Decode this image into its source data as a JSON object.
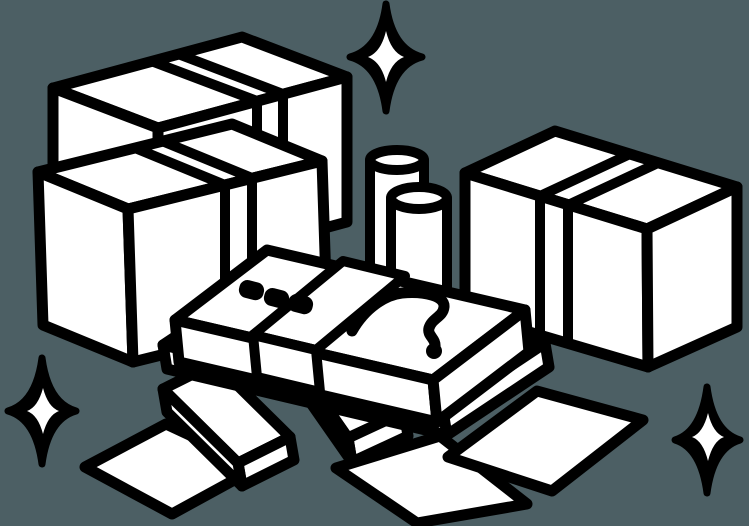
{
  "scene": {
    "title": "Packed boxes and money pile clipart",
    "description": "Monochrome line-art illustration of sealed cardboard boxes, coin rolls, a banded stack of banknotes with dots and a scribble mark, thin slabs and loose flat sheets of paper, decorated with four-point sparkles on a slate background.",
    "colors": {
      "background": "#4c5f64",
      "ink": "#000000",
      "paper": "#ffffff"
    },
    "elements": [
      {
        "name": "sparkle-top",
        "kind": "four-point-sparkle"
      },
      {
        "name": "sparkle-bottom-left",
        "kind": "four-point-sparkle"
      },
      {
        "name": "sparkle-bottom-right",
        "kind": "four-point-sparkle"
      },
      {
        "name": "box-back-left",
        "kind": "sealed-cardboard-box",
        "marks": [
          "tape-band"
        ]
      },
      {
        "name": "box-front-left",
        "kind": "sealed-cardboard-box",
        "marks": [
          "tape-band"
        ]
      },
      {
        "name": "box-right",
        "kind": "sealed-cardboard-box",
        "marks": [
          "tape-band"
        ]
      },
      {
        "name": "coin-roll-back",
        "kind": "cylinder-roll"
      },
      {
        "name": "coin-roll-front",
        "kind": "cylinder-roll"
      },
      {
        "name": "banknote-stack-main",
        "kind": "banded-stack",
        "marks": [
          "wrap-band",
          "three-dots-mark",
          "scribble-mark"
        ]
      },
      {
        "name": "banknote-stack-under",
        "kind": "stack-layer"
      },
      {
        "name": "slab-bottom-left",
        "kind": "thin-stack"
      },
      {
        "name": "slab-bottom-middle",
        "kind": "thin-stack"
      },
      {
        "name": "paper-sheet-left",
        "kind": "flat-sheet"
      },
      {
        "name": "paper-sheet-bottom",
        "kind": "flat-sheet"
      },
      {
        "name": "paper-sheet-right",
        "kind": "flat-sheet"
      }
    ]
  }
}
